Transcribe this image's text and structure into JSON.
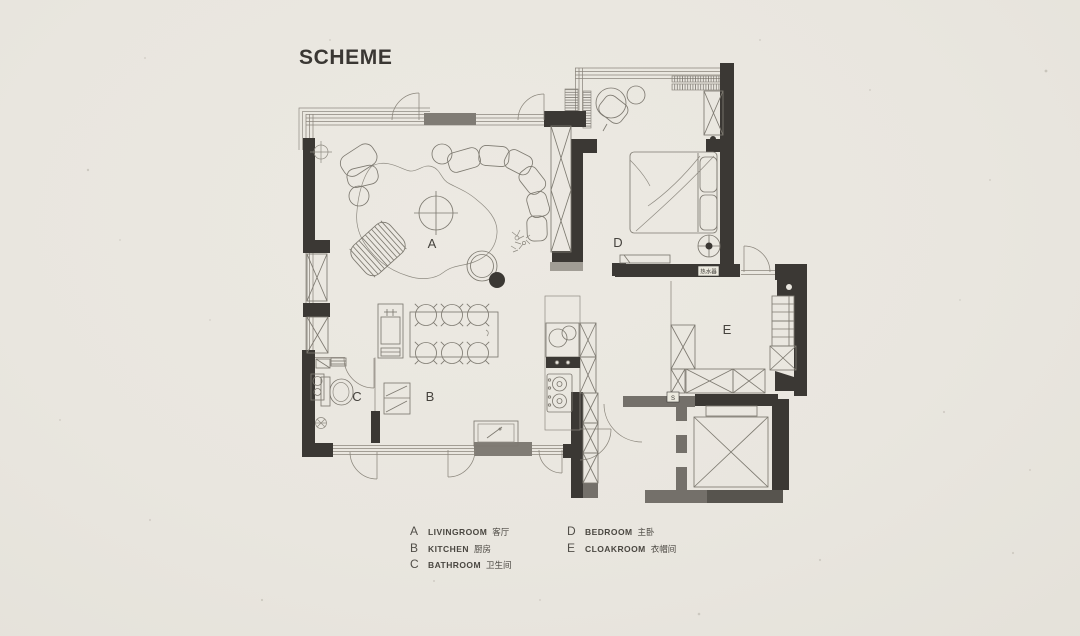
{
  "title": "SCHEME",
  "colors": {
    "background": "#e9e6df",
    "wall_dark": "#3b3834",
    "wall_gray": "#74706a",
    "wall_light": "#a19d95",
    "line": "#8b867c",
    "text": "#4a4741"
  },
  "plan": {
    "room_labels": [
      {
        "id": "A",
        "x": 432,
        "y": 248
      },
      {
        "id": "B",
        "x": 430,
        "y": 401
      },
      {
        "id": "C",
        "x": 357,
        "y": 401
      },
      {
        "id": "D",
        "x": 618,
        "y": 247
      },
      {
        "id": "E",
        "x": 727,
        "y": 334
      }
    ],
    "annotations": {
      "water_heater": "热水器",
      "switch": "S"
    }
  },
  "legend": {
    "columns": [
      {
        "items": [
          {
            "letter": "A",
            "name": "LIVINGROOM",
            "cn": "客厅"
          },
          {
            "letter": "B",
            "name": "KITCHEN",
            "cn": "厨房"
          },
          {
            "letter": "C",
            "name": "BATHROOM",
            "cn": "卫生间"
          }
        ]
      },
      {
        "items": [
          {
            "letter": "D",
            "name": "BEDROOM",
            "cn": "主卧"
          },
          {
            "letter": "E",
            "name": "CLOAKROOM",
            "cn": "衣帽间"
          }
        ]
      }
    ]
  }
}
